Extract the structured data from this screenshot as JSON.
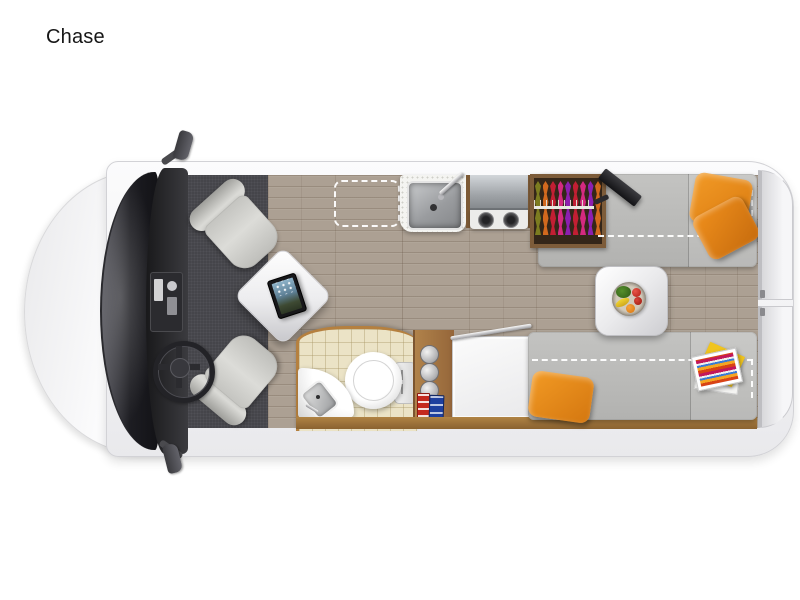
{
  "page": {
    "background": "#ffffff",
    "title": "Chase"
  },
  "floorplan": {
    "view": "top-down camper van floor plan",
    "accent_colors": {
      "pillow_orange": "#ee8c1c",
      "sofa_gray": "#b9b9b7",
      "wood_floor": "#aca093",
      "bathroom_tile": "#ebe3c6",
      "wood_trim": "#a97b44",
      "cab_carpet": "#45454a",
      "dashed_outline": "#ffffff"
    },
    "areas": {
      "cab": {
        "items": [
          "driver-swivel-seat",
          "passenger-swivel-seat",
          "steering-wheel",
          "dashboard",
          "windshield",
          "pedestal-table",
          "tablet",
          "side-mirror-top",
          "side-mirror-bottom"
        ]
      },
      "galley": {
        "items": [
          "sink",
          "faucet",
          "stainless-flip-cover",
          "two-burner-stove",
          "speckled-counter",
          "optional-space-dashed-outline"
        ]
      },
      "wardrobe": {
        "items": [
          "hanging-clothes",
          "clothes-rod",
          "tv-on-swivel-mount"
        ]
      },
      "bathroom": {
        "items": [
          "toilet",
          "corner-sink",
          "towel-bar",
          "storage-shelf",
          "canisters",
          "toiletry-boxes",
          "white-cabinet"
        ]
      },
      "rear_lounge": {
        "items": [
          "sofa-bench-top",
          "sofa-bench-bottom",
          "pedestal-table",
          "fruit-bowl",
          "orange-throw-pillows",
          "magazines",
          "bed-conversion-dashed-outline"
        ]
      },
      "rear": {
        "items": [
          "rear-door-top-panel",
          "rear-door-bottom-panel"
        ]
      }
    }
  }
}
